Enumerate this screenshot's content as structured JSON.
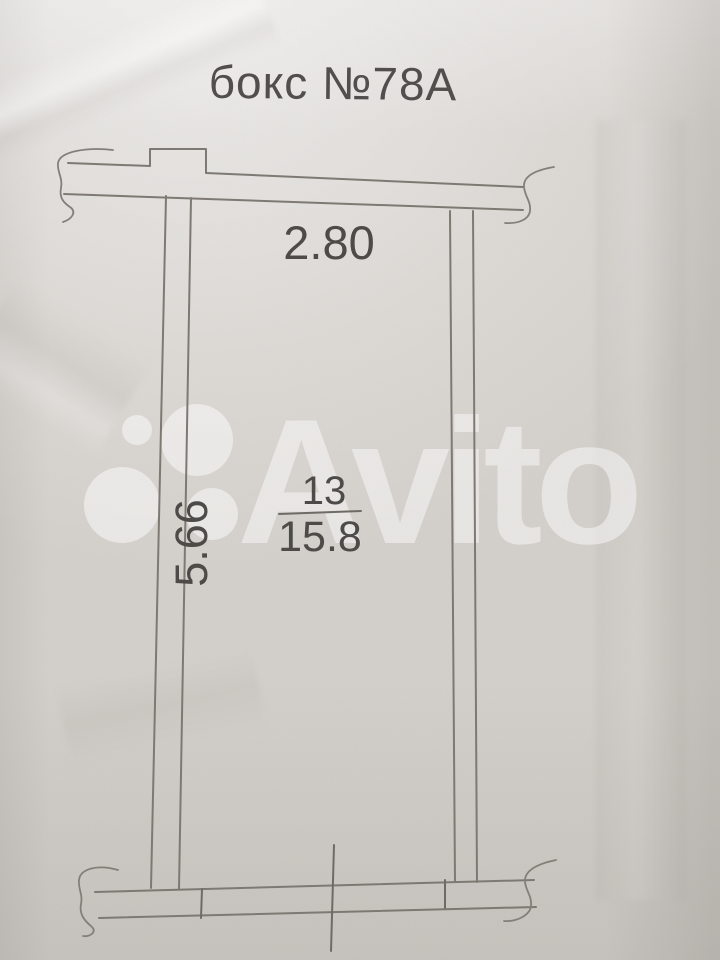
{
  "document": {
    "title": "бокс №78А"
  },
  "plan": {
    "dimensions": {
      "width_m": "2.80",
      "depth_m": "5.66"
    },
    "room": {
      "number": "13",
      "area_sq_m": "15.8"
    }
  },
  "watermark": {
    "brand": "Avito",
    "logo_icon": "avito-circles-icon"
  },
  "colors": {
    "paper": "#d3cfca",
    "ink_line": "#7c7770",
    "ink_text": "#4a4845",
    "watermark": "#ffffff"
  }
}
